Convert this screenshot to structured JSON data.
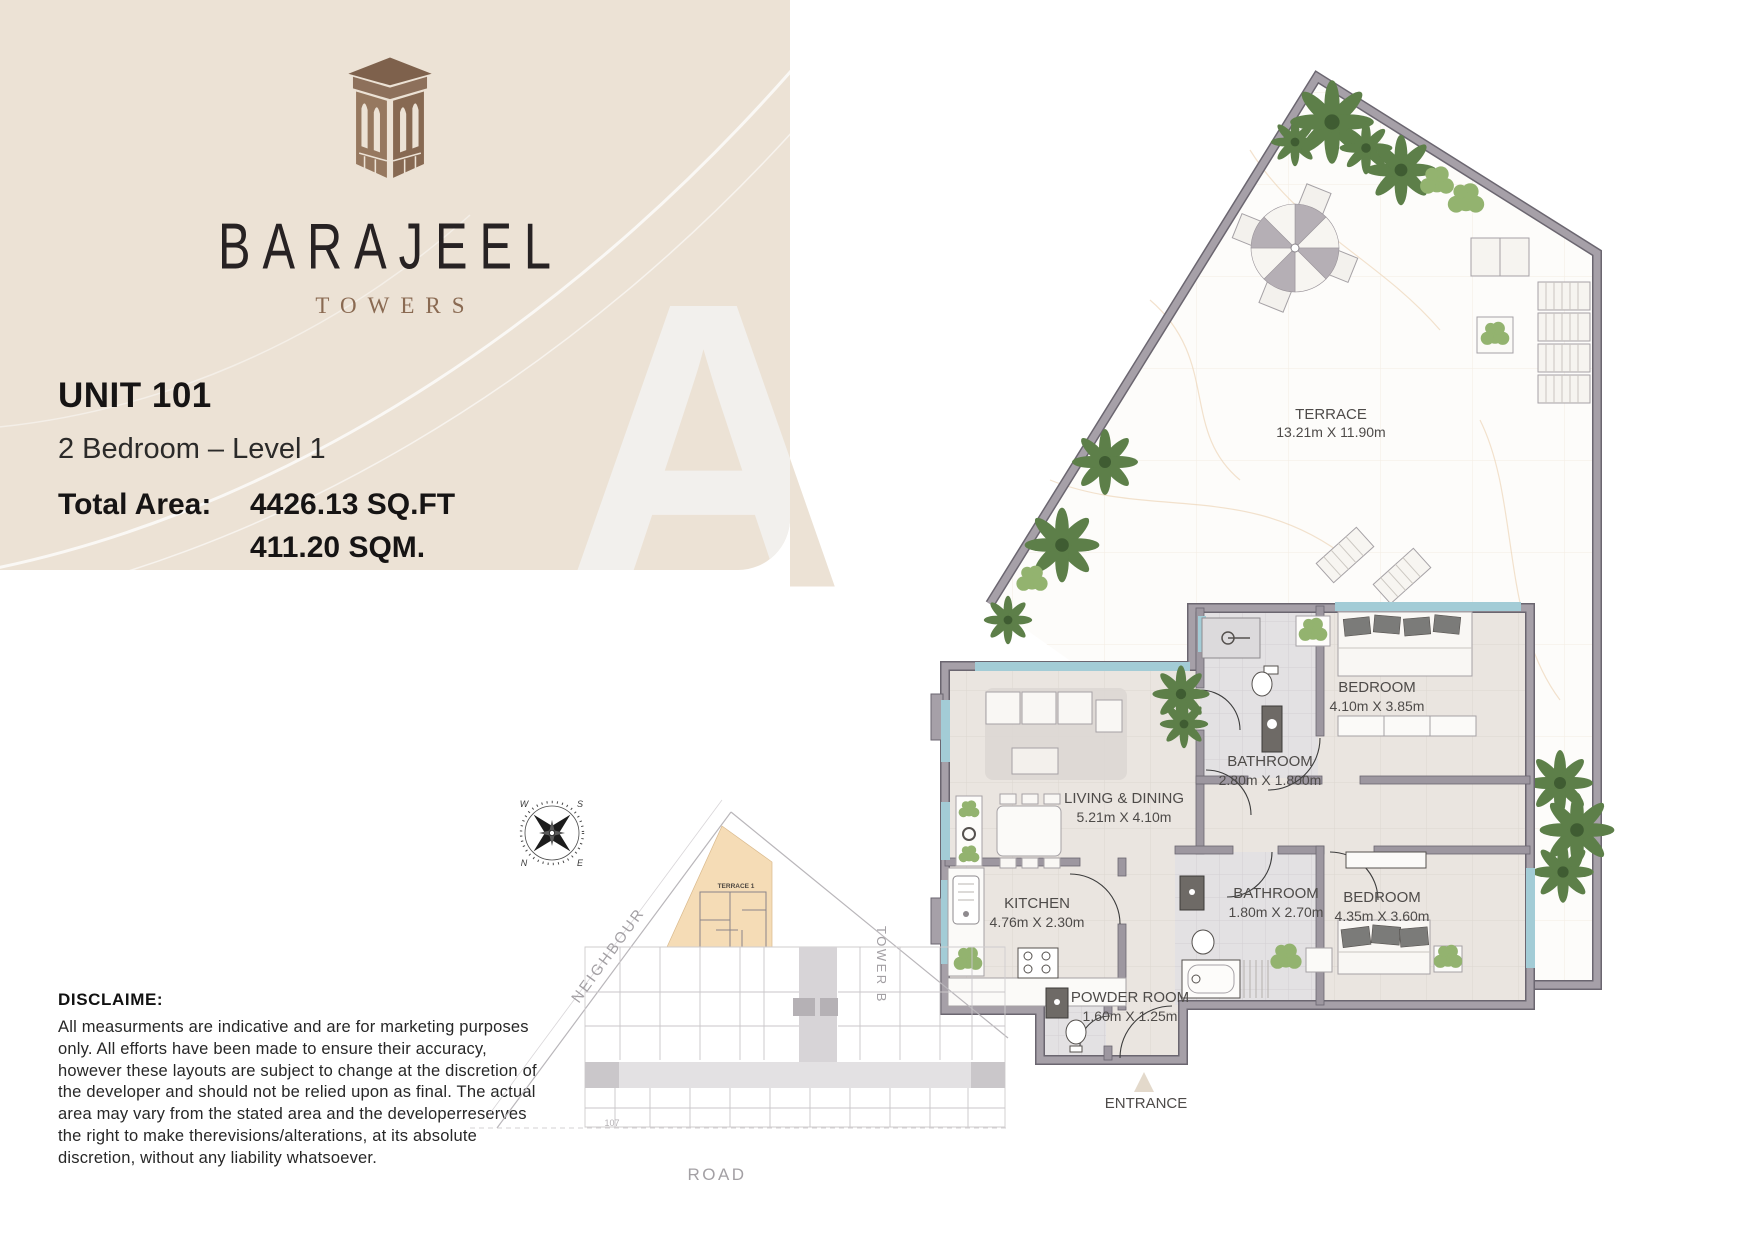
{
  "branding": {
    "logo_name": "BARAJEEL",
    "logo_subtitle": "TOWERS",
    "watermark_letter": "A"
  },
  "unit": {
    "title": "UNIT 101",
    "type_level": "2 Bedroom – Level 1",
    "total_area_label": "Total Area:",
    "area_sqft": "4426.13 SQ.FT",
    "area_sqm": "411.20 SQM."
  },
  "floor_plan": {
    "terrace": {
      "name": "TERRACE",
      "dims": "13.21m X 11.90m"
    },
    "living": {
      "name": "LIVING & DINING",
      "dims": "5.21m X 4.10m"
    },
    "kitchen": {
      "name": "KITCHEN",
      "dims": "4.76m X 2.30m"
    },
    "bathroom1": {
      "name": "BATHROOM",
      "dims": "2.80m X 1.800m"
    },
    "bathroom2": {
      "name": "BATHROOM",
      "dims": "1.80m X 2.70m"
    },
    "bedroom1": {
      "name": "BEDROOM",
      "dims": "4.10m X 3.85m"
    },
    "bedroom2": {
      "name": "BEDROOM",
      "dims": "4.35m X 3.60m"
    },
    "powder": {
      "name": "POWDER ROOM",
      "dims": "1.60m X 1.25m"
    },
    "entrance_label": "ENTRANCE"
  },
  "site_plan": {
    "neighbour": "NEIGHBOUR",
    "tower_b": "TOWER B",
    "road": "ROAD",
    "terrace_tag": "TERRACE 1",
    "unit_tag": "107",
    "compass": {
      "n": "N",
      "s": "S",
      "e": "E",
      "w": "W"
    }
  },
  "disclaimer": {
    "title": "DISCLAIME:",
    "body": "All measurments are indicative and are for marketing purposes only. All efforts have been made to ensure their accuracy, however these layouts are subject to change at the discretion of the developer and should not be relied upon as final. The actual area may vary from the stated area and the developerreserves the right to make therevisions/alterations, at its absolute discretion, without any liability whatsoever."
  },
  "colors": {
    "panel_beige": "#ece2d5",
    "logo_brown": "#8d705b",
    "towers_brown": "#8a6a52",
    "wall_gray": "#a29ca4",
    "glazing_blue": "#a3ccd6",
    "palm_green": "#5d7f49",
    "site_terrace_beige": "#f5dcb6",
    "floor_tile": "#eae5e0",
    "terrace_marble": "#fdfcfa"
  }
}
